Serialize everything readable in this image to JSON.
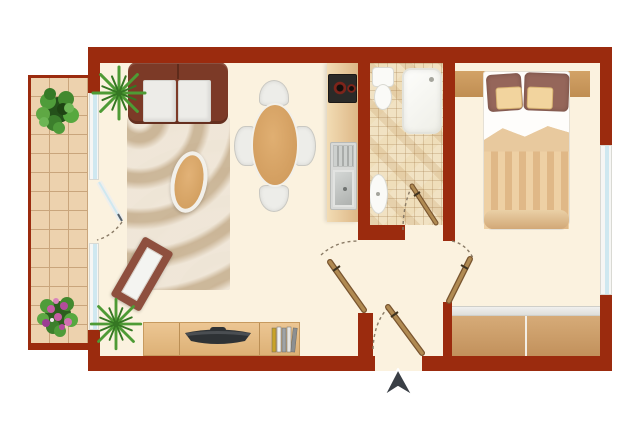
{
  "plan": {
    "type": "apartment-floor-plan",
    "rooms": [
      "balcony",
      "living-room",
      "dining-area",
      "kitchen",
      "bathroom",
      "hallway",
      "bedroom"
    ],
    "entry_marker": {
      "symbol": "arrow-up",
      "location": "bottom-center-at-entrance-door"
    },
    "furniture": {
      "balcony": [
        "potted-shrub",
        "flowering-plant"
      ],
      "living_room": [
        "sofa-two-seat",
        "area-rug-zebra",
        "coffee-table-oval",
        "wall-mirror-diamond",
        "palm-plant-upper",
        "palm-plant-lower",
        "tv-sideboard",
        "television",
        "books"
      ],
      "dining_area": [
        "dining-table-oval",
        "dining-chair-north",
        "dining-chair-south",
        "dining-chair-west",
        "dining-chair-east"
      ],
      "kitchen": [
        "kitchen-counter",
        "cooktop-two-burners",
        "sink-with-drainboard"
      ],
      "bathroom": [
        "toilet",
        "bathtub",
        "washbasin"
      ],
      "bedroom": [
        "double-bed",
        "headboard-shelf",
        "pillows",
        "striped-duvet",
        "wardrobe-two-door"
      ]
    },
    "openings": [
      "balcony-glass-door",
      "balcony-window-upper",
      "balcony-window-lower",
      "living-room-door",
      "bathroom-door",
      "bedroom-door",
      "entrance-door",
      "bedroom-window"
    ]
  },
  "colors": {
    "wall": "#9B2B0E",
    "floor": "#FBF2DF",
    "tile": "#EDD2AE",
    "tile-line": "#C9A57C",
    "mosaic": "#F1E2C3",
    "counter": "#EBCB9C",
    "cooktop": "#2B2A28",
    "burner": "#7E241A",
    "sofa": "#7C3A27",
    "cushion": "#EDECE8",
    "wood": "#D8A76A",
    "chair": "#EDEDE9",
    "chair-edge": "#C9C8C2",
    "mirror": "#8E4F3E",
    "glass-white": "#F6F6F4",
    "glass": "#CFE8F0",
    "board-line": "#BB8F55",
    "tv": "#2E3235",
    "bed-white": "#FEFDFB",
    "pil-a": "#95665A",
    "pil-b": "#F2D49E",
    "duvet-a": "#EED0A4",
    "duvet-b": "#E0B887",
    "door": "#B08A52",
    "door-dark": "#79552F",
    "arc": "#8A7B66",
    "arrow": "#3A3F46",
    "palm": "#4E9B35",
    "palm-dark": "#357723",
    "flower": "#C55CA5"
  }
}
